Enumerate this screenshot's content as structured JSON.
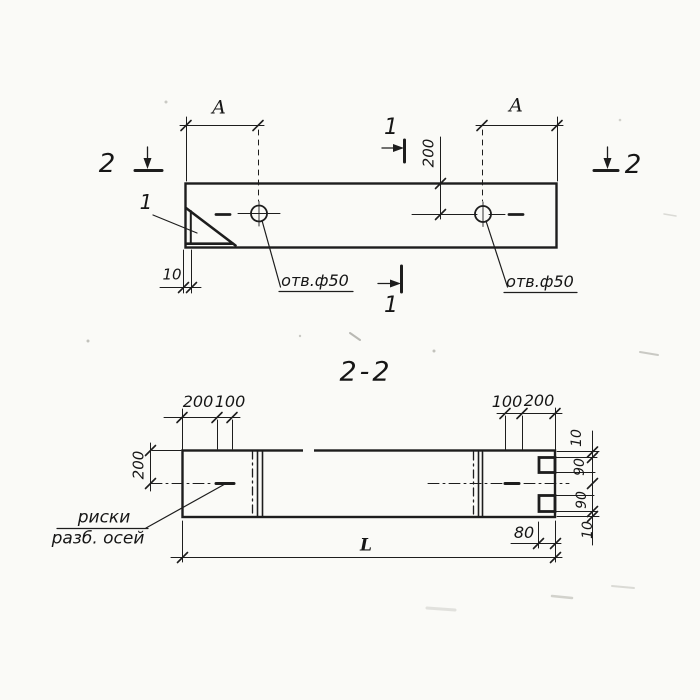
{
  "page": {
    "background": "#fafaf7",
    "ink": "#1b1b1b",
    "description": "scanned technical drawing, plan view and section 2-2 of precast concrete element"
  },
  "plan_view": {
    "dim_a_left": "A",
    "dim_a_right": "A",
    "dim_200": "200",
    "dim_10": "10",
    "detail_mark": "1",
    "section_mark_1_top": "1",
    "section_mark_1_bottom": "1",
    "section_mark_2_left": "2",
    "section_mark_2_right": "2",
    "hole_callout_left": "отв.ф50",
    "hole_callout_right": "отв.ф50"
  },
  "section_view": {
    "title": "2-2",
    "dim_200_top_left": "200",
    "dim_100_top_left": "100",
    "dim_100_top_right": "100",
    "dim_200_top_right": "200",
    "dim_height_200": "200",
    "dim_right_10_top": "10",
    "dim_right_90_top": "90",
    "dim_right_90_bottom": "90",
    "dim_right_10_bottom": "10",
    "dim_80": "80",
    "dim_length": "L",
    "axis_marks_label_line1": "риски",
    "axis_marks_label_line2": "разб. осей"
  }
}
